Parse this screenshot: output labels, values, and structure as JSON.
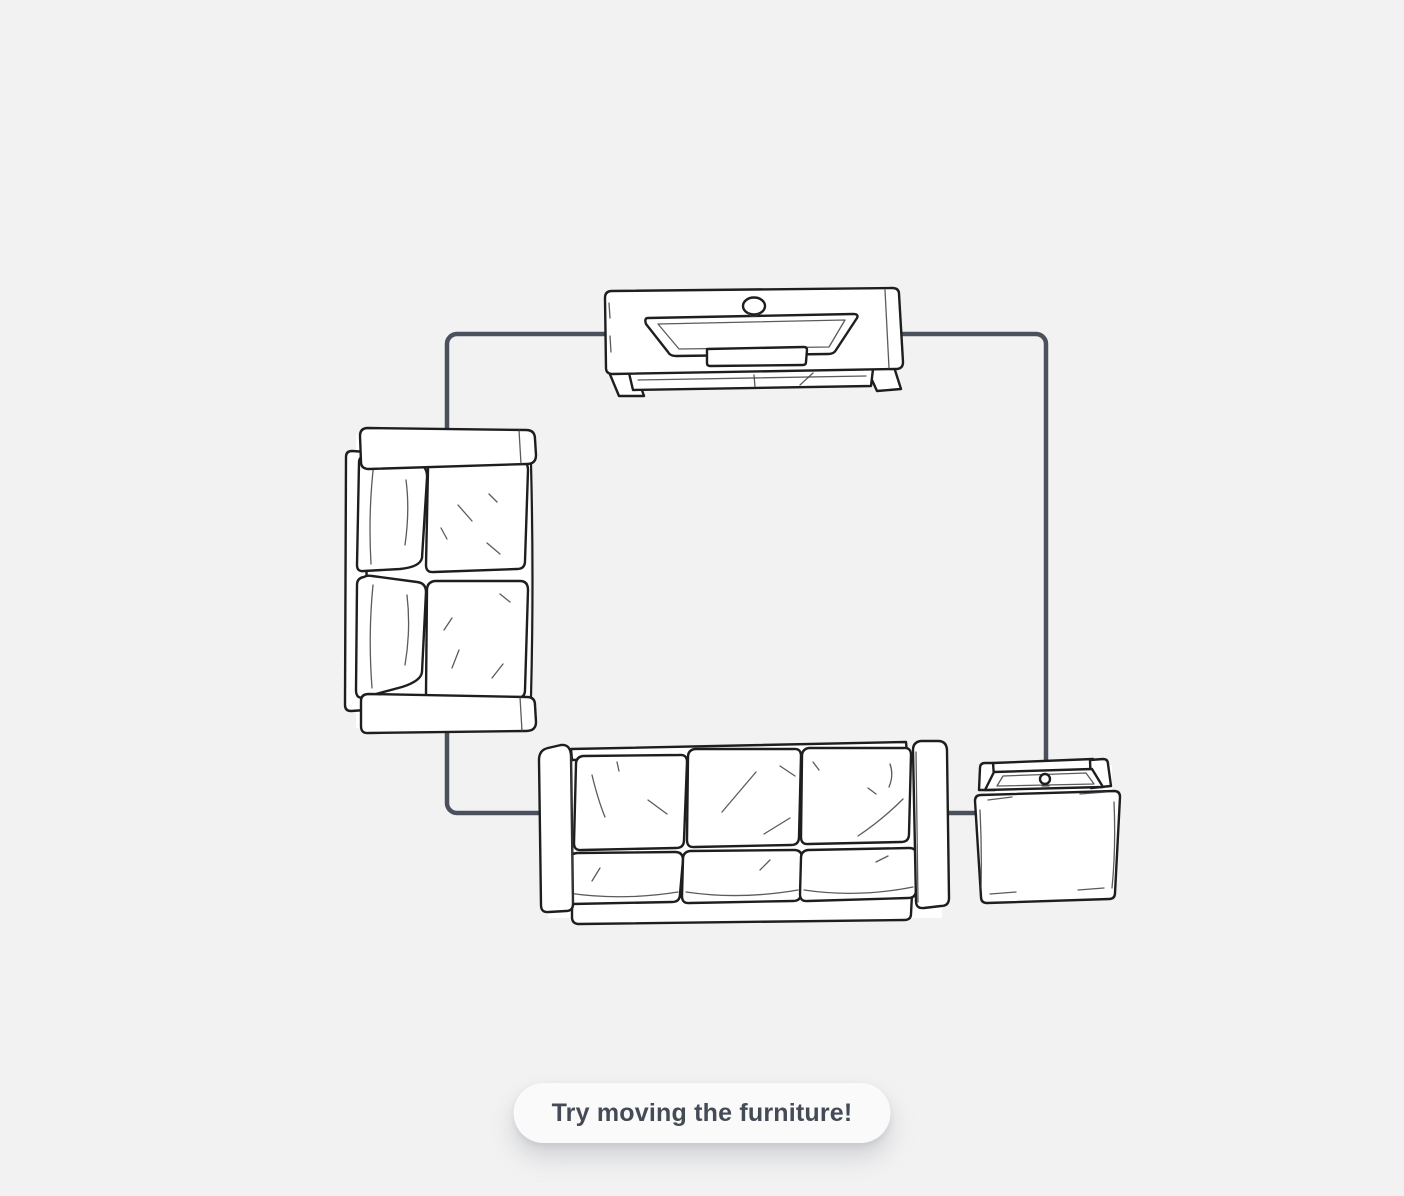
{
  "theme": {
    "background": "#f2f2f2",
    "wall_color": "#4b515c",
    "ink": "#1e1e20",
    "ink_soft": "#3e3e42",
    "furniture_fill": "#ffffff",
    "pill_background": "#fafafa",
    "pill_text": "#444b57",
    "pill_shadow": "rgba(148,153,163,0.35)"
  },
  "hint": {
    "label": "Try moving the furniture!"
  },
  "room": {
    "furniture_icons": [
      "tv-console-icon",
      "loveseat-icon",
      "three-seat-sofa-icon",
      "side-table-icon"
    ]
  }
}
